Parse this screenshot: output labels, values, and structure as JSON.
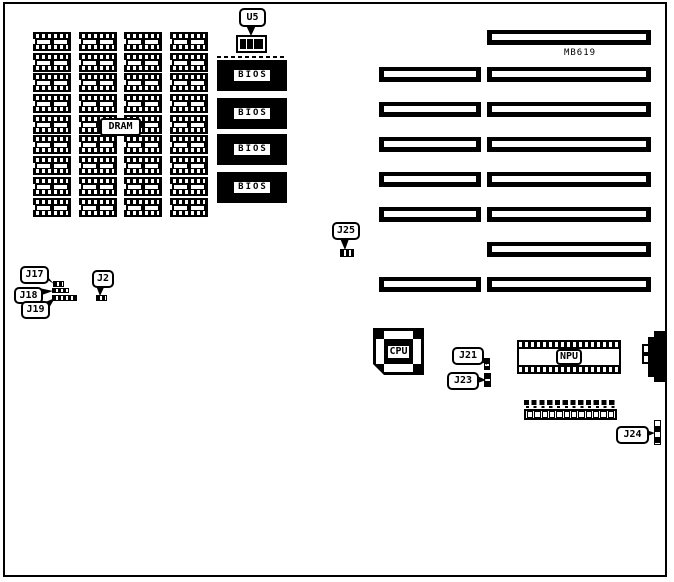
{
  "colors": {
    "ink": "#000000",
    "paper": "#ffffff"
  },
  "model_label": "MB619",
  "dram": {
    "label": "DRAM",
    "columns": 4,
    "rows": 9
  },
  "u5": {
    "label": "U5",
    "blocks": 3
  },
  "bios": {
    "chips": [
      "BIOS",
      "BIOS",
      "BIOS",
      "BIOS"
    ]
  },
  "slots": {
    "left_count": 6,
    "right_count": 8
  },
  "cpu": {
    "label": "CPU"
  },
  "npu": {
    "label": "NPU"
  },
  "power_connector": {
    "socket_squares": 12,
    "top_pins": 12
  },
  "jumpers": {
    "j17": "J17",
    "j18": "J18",
    "j19": "J19",
    "j2": "J2",
    "j25": "J25",
    "j21": "J21",
    "j23": "J23",
    "j24": "J24"
  }
}
